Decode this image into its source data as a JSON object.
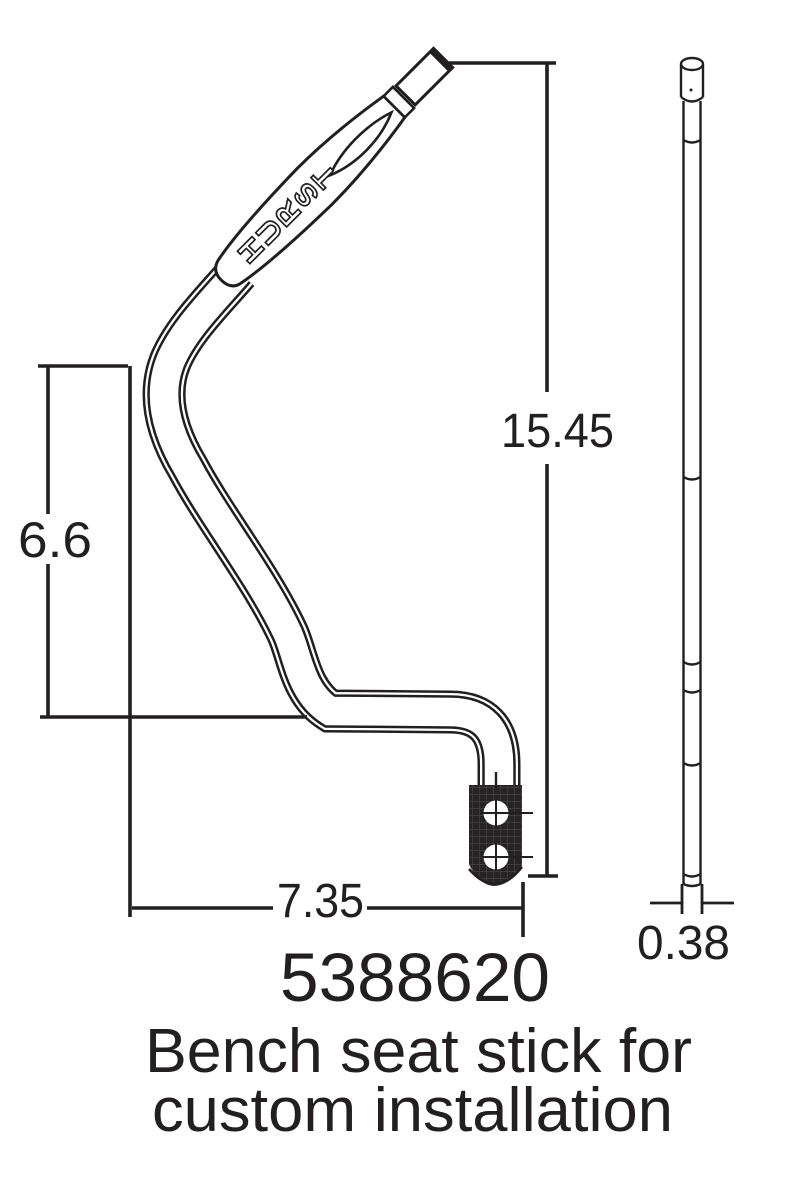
{
  "drawing": {
    "brand": {
      "name": "HURST",
      "letters": [
        "H",
        "U",
        "R",
        "S",
        "T"
      ]
    },
    "dimensions": {
      "total_height": "15.45",
      "bend_height": "6.6",
      "overall_width": "7.35",
      "rod_diameter": "0.38"
    },
    "part_number": "5388620",
    "caption_line1": "Bench seat stick for",
    "caption_line2": "custom installation",
    "colors": {
      "ink": "#231f20",
      "background": "#ffffff",
      "bracket_fill": "#272223"
    }
  }
}
